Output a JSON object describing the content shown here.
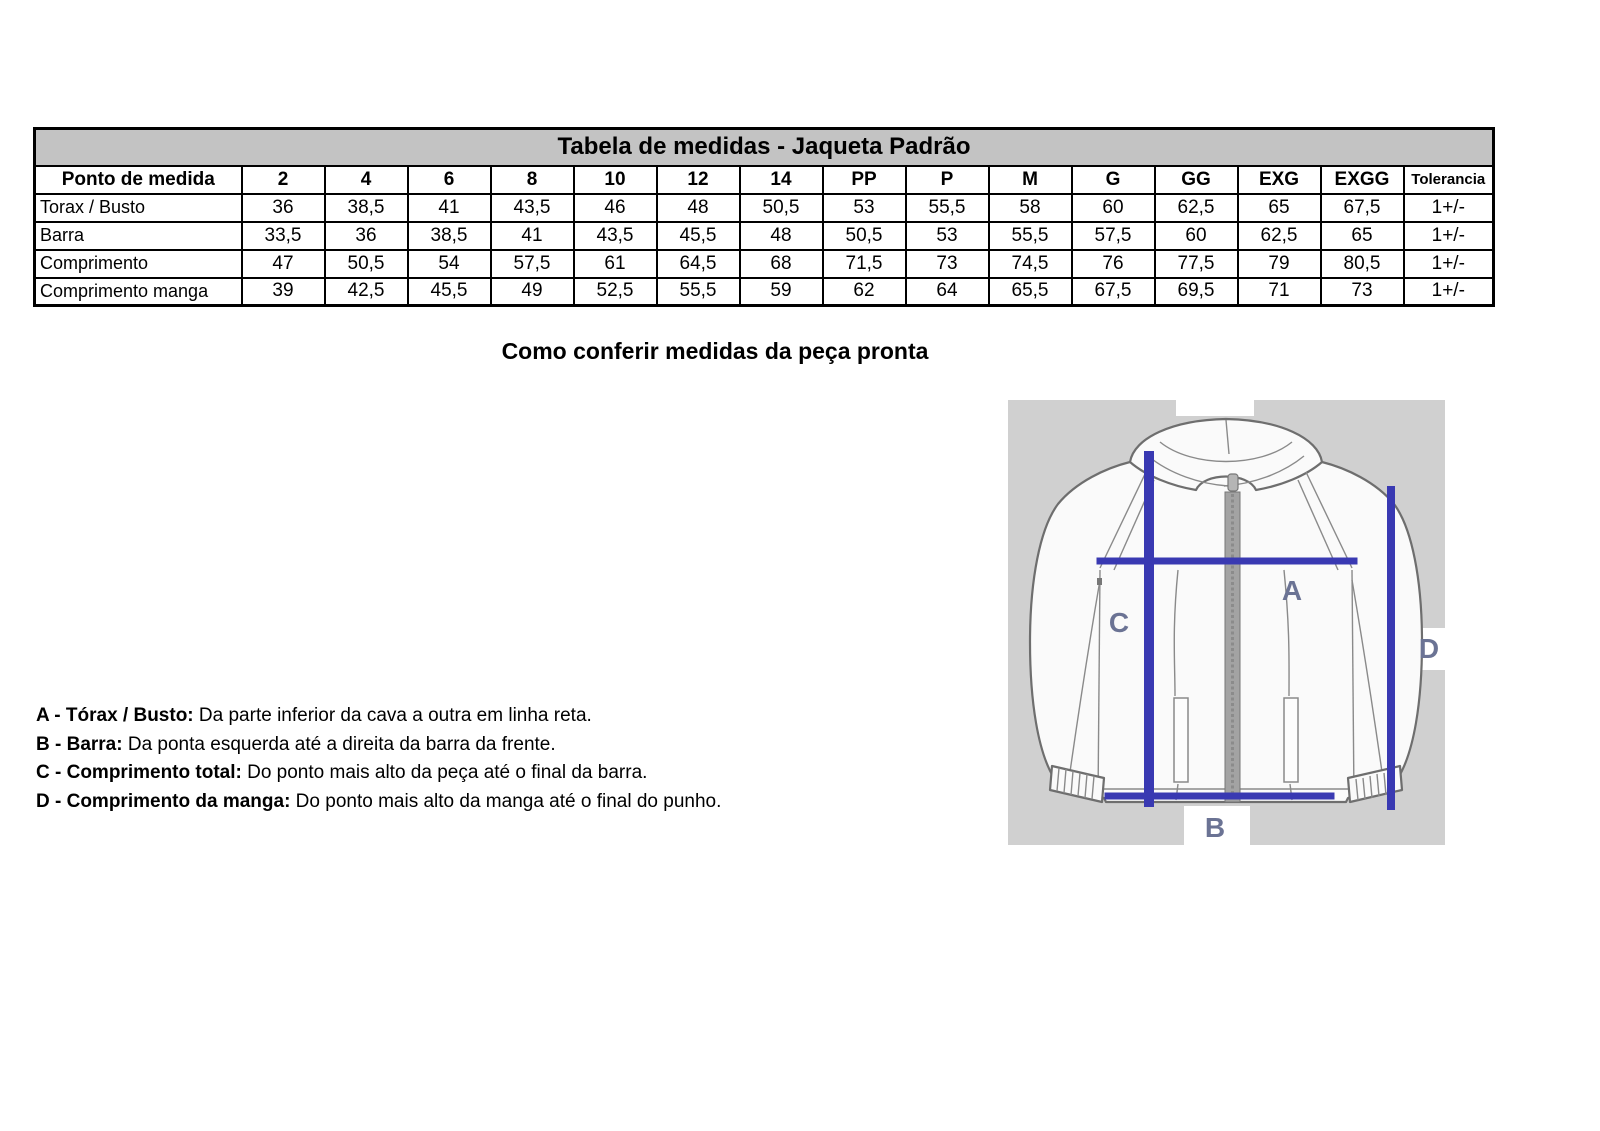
{
  "table": {
    "title": "Tabela de medidas - Jaqueta Padrão",
    "title_bg": "#c3c3c3",
    "header": [
      "Ponto de medida",
      "2",
      "4",
      "6",
      "8",
      "10",
      "12",
      "14",
      "PP",
      "P",
      "M",
      "G",
      "GG",
      "EXG",
      "EXGG",
      "Tolerancia"
    ],
    "rows": [
      {
        "label": "Torax / Busto",
        "values": [
          "36",
          "38,5",
          "41",
          "43,5",
          "46",
          "48",
          "50,5",
          "53",
          "55,5",
          "58",
          "60",
          "62,5",
          "65",
          "67,5",
          "1+/-"
        ]
      },
      {
        "label": "Barra",
        "values": [
          "33,5",
          "36",
          "38,5",
          "41",
          "43,5",
          "45,5",
          "48",
          "50,5",
          "53",
          "55,5",
          "57,5",
          "60",
          "62,5",
          "65",
          "1+/-"
        ]
      },
      {
        "label": "Comprimento",
        "values": [
          "47",
          "50,5",
          "54",
          "57,5",
          "61",
          "64,5",
          "68",
          "71,5",
          "73",
          "74,5",
          "76",
          "77,5",
          "79",
          "80,5",
          "1+/-"
        ]
      },
      {
        "label": "Comprimento manga",
        "values": [
          "39",
          "42,5",
          "45,5",
          "49",
          "52,5",
          "55,5",
          "59",
          "62",
          "64",
          "65,5",
          "67,5",
          "69,5",
          "71",
          "73",
          "1+/-"
        ]
      }
    ]
  },
  "subtitle": "Como conferir medidas da peça pronta",
  "notes": [
    {
      "label": "A - Tórax / Busto:",
      "text": " Da parte inferior da cava a outra em linha reta."
    },
    {
      "label": "B - Barra:",
      "text": " Da ponta esquerda até a direita da barra da frente."
    },
    {
      "label": "C - Comprimento total:",
      "text": " Do ponto mais alto da peça até o final da barra."
    },
    {
      "label": "D - Comprimento da manga:",
      "text": " Do ponto mais alto da manga até o final do punho."
    }
  ],
  "diagram": {
    "bg": "#d0d0d0",
    "line_color": "#3939b2",
    "label_color": "#6b7394",
    "labels": {
      "a": "A",
      "b": "B",
      "c": "C",
      "d": "D"
    }
  }
}
